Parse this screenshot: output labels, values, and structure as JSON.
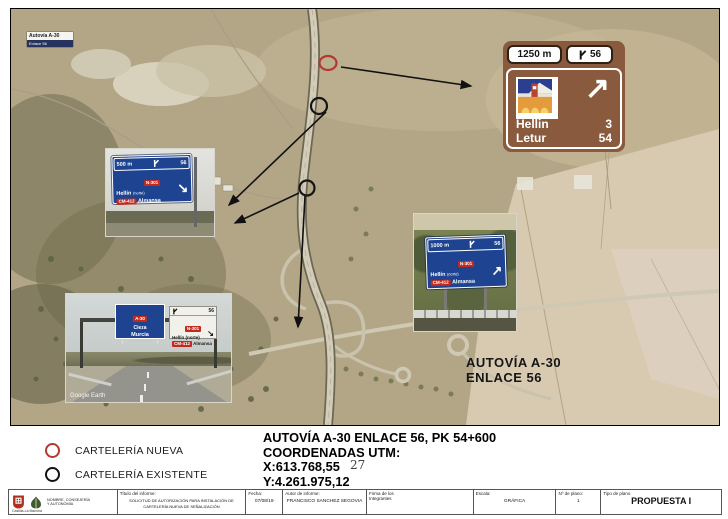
{
  "legend": {
    "new_label": "CARTELERÍA NUEVA",
    "existing_label": "CARTELERÍA EXISTENTE"
  },
  "note": {
    "line1": "AUTOVÍA A-30 ENLACE 56, PK 54+600",
    "line2": "COORDENADAS UTM:",
    "line3": "X:613.768,55",
    "line4": "Y:4.261.975,12",
    "page_number": "27"
  },
  "map": {
    "corner_badge_line1": "Autovía A-30",
    "corner_badge_line2": "Enlace 56",
    "area_label_line1": "AUTOVÍA A-30",
    "area_label_line2": "ENLACE 56",
    "watermark": "Google Earth"
  },
  "proposed_sign": {
    "distance": "1250 m",
    "exit_number": "56",
    "arrow": "↗",
    "rows": [
      {
        "name": "Hellin",
        "km": "3"
      },
      {
        "name": "Letur",
        "km": "54"
      }
    ]
  },
  "sign_500": {
    "distance": "500 m",
    "exit": "56",
    "badge1": "N-301",
    "dest1": "Hellín",
    "dest1_sub": "(norte)",
    "badge2": "CM-412",
    "dest2": "Almansa",
    "arrow": "↘"
  },
  "sign_1000": {
    "distance": "1000 m",
    "exit": "56",
    "badge1": "N-301",
    "dest1": "Hellín",
    "dest1_sub": "(norte)",
    "badge2": "CM-412",
    "dest2": "Almansa",
    "arrow": "↗"
  },
  "gantry": {
    "left_route": "A-30",
    "left_dest1": "Cieza",
    "left_dest2": "Murcia",
    "left_arrow": "↓",
    "right_exit": "56",
    "right_badge1": "N-301",
    "right_dest1": "Hellín (norte)",
    "right_badge2": "CM-412",
    "right_dest2": "Almansa",
    "right_arrow": "↘"
  },
  "titleblock": {
    "org_caption": "NOMBRE, CONSEJERÍA Y AUTONOMÍA",
    "logo1_caption": "Castilla-La Mancha",
    "title_label": "Título del informe:",
    "title_value": "SOLICITUD DE AUTORIZACIÓN PARA INSTALACIÓN DE CARTELERÍA NUEVA DE SEÑALIZACIÓN",
    "date_label": "Fecha:",
    "date_value": "07/08/19",
    "author_label": "Autor de informe:",
    "author_value": "FRANCISCO SANCHEZ SEGOVIA",
    "signature_label": "Firma de los Integrantes",
    "scale_label": "Escala:",
    "scale_value": "GRÁFICA",
    "plan_no_label": "Nº de plano:",
    "plan_no_value": "1",
    "plan_type_label": "Tipo de plano",
    "plan_type_value": "PROPUESTA I"
  },
  "colors": {
    "sign_brown": "#8a5a3e",
    "sign_blue": "#1e4390",
    "badge_red": "#c4291d",
    "legend_new": "#b03a2e",
    "legend_existing": "#111111"
  }
}
